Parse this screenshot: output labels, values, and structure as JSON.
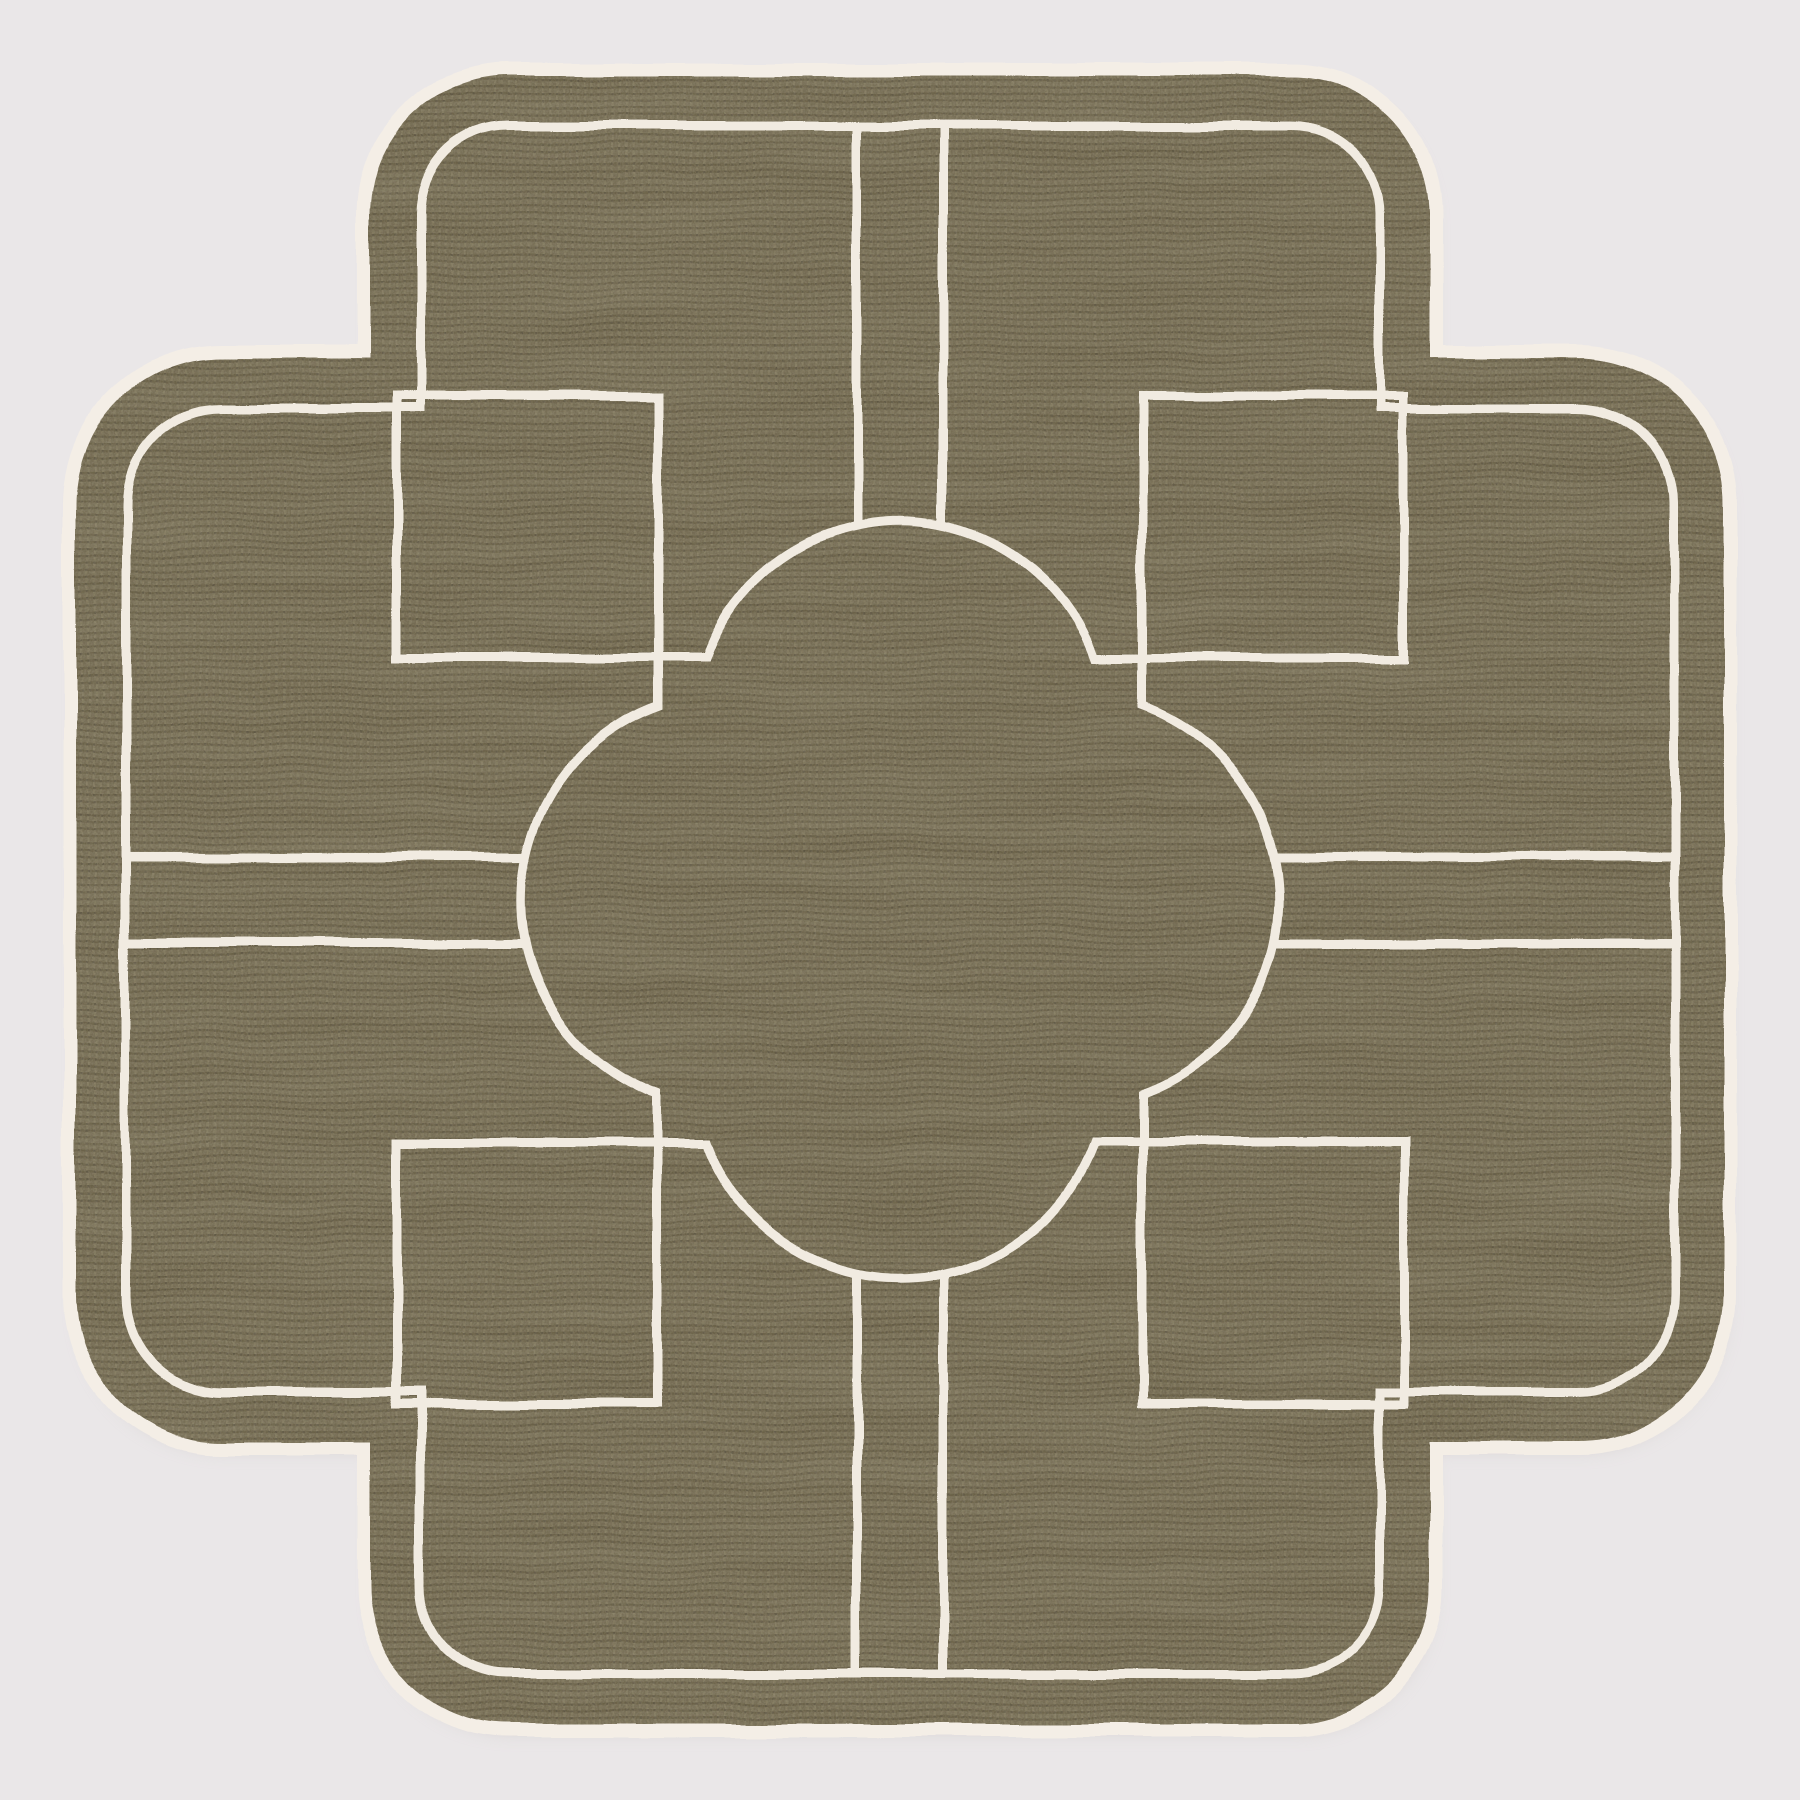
{
  "canvas": {
    "width": 1800,
    "height": 1800,
    "background": "#eae7e8"
  },
  "placemat": {
    "fabric_base": "#716850",
    "fabric_weft": "#655c43",
    "fabric_warp": "#7b7258",
    "fabric_knot": "#5c5440",
    "speckle_light": "#d8cfb4",
    "speckle_dark": "#3f3928",
    "trim_color": "#f4eee6",
    "line_color": "#f1ebe1",
    "shadow_color": "#c9c3c1",
    "trim_width": 26,
    "line_width": 9,
    "geometry": {
      "center": 900,
      "edge": 76,
      "top_half": 392,
      "corner_arc1_r": 138,
      "corner_step_y": 358,
      "corner_ledge_x": 222,
      "corner_arc2_r": 146,
      "border_inset": 50,
      "square_outer": 396,
      "square_inner": 658,
      "lobe_offset": 173,
      "lobe_r": 206,
      "path_gap_half": 43
    }
  }
}
